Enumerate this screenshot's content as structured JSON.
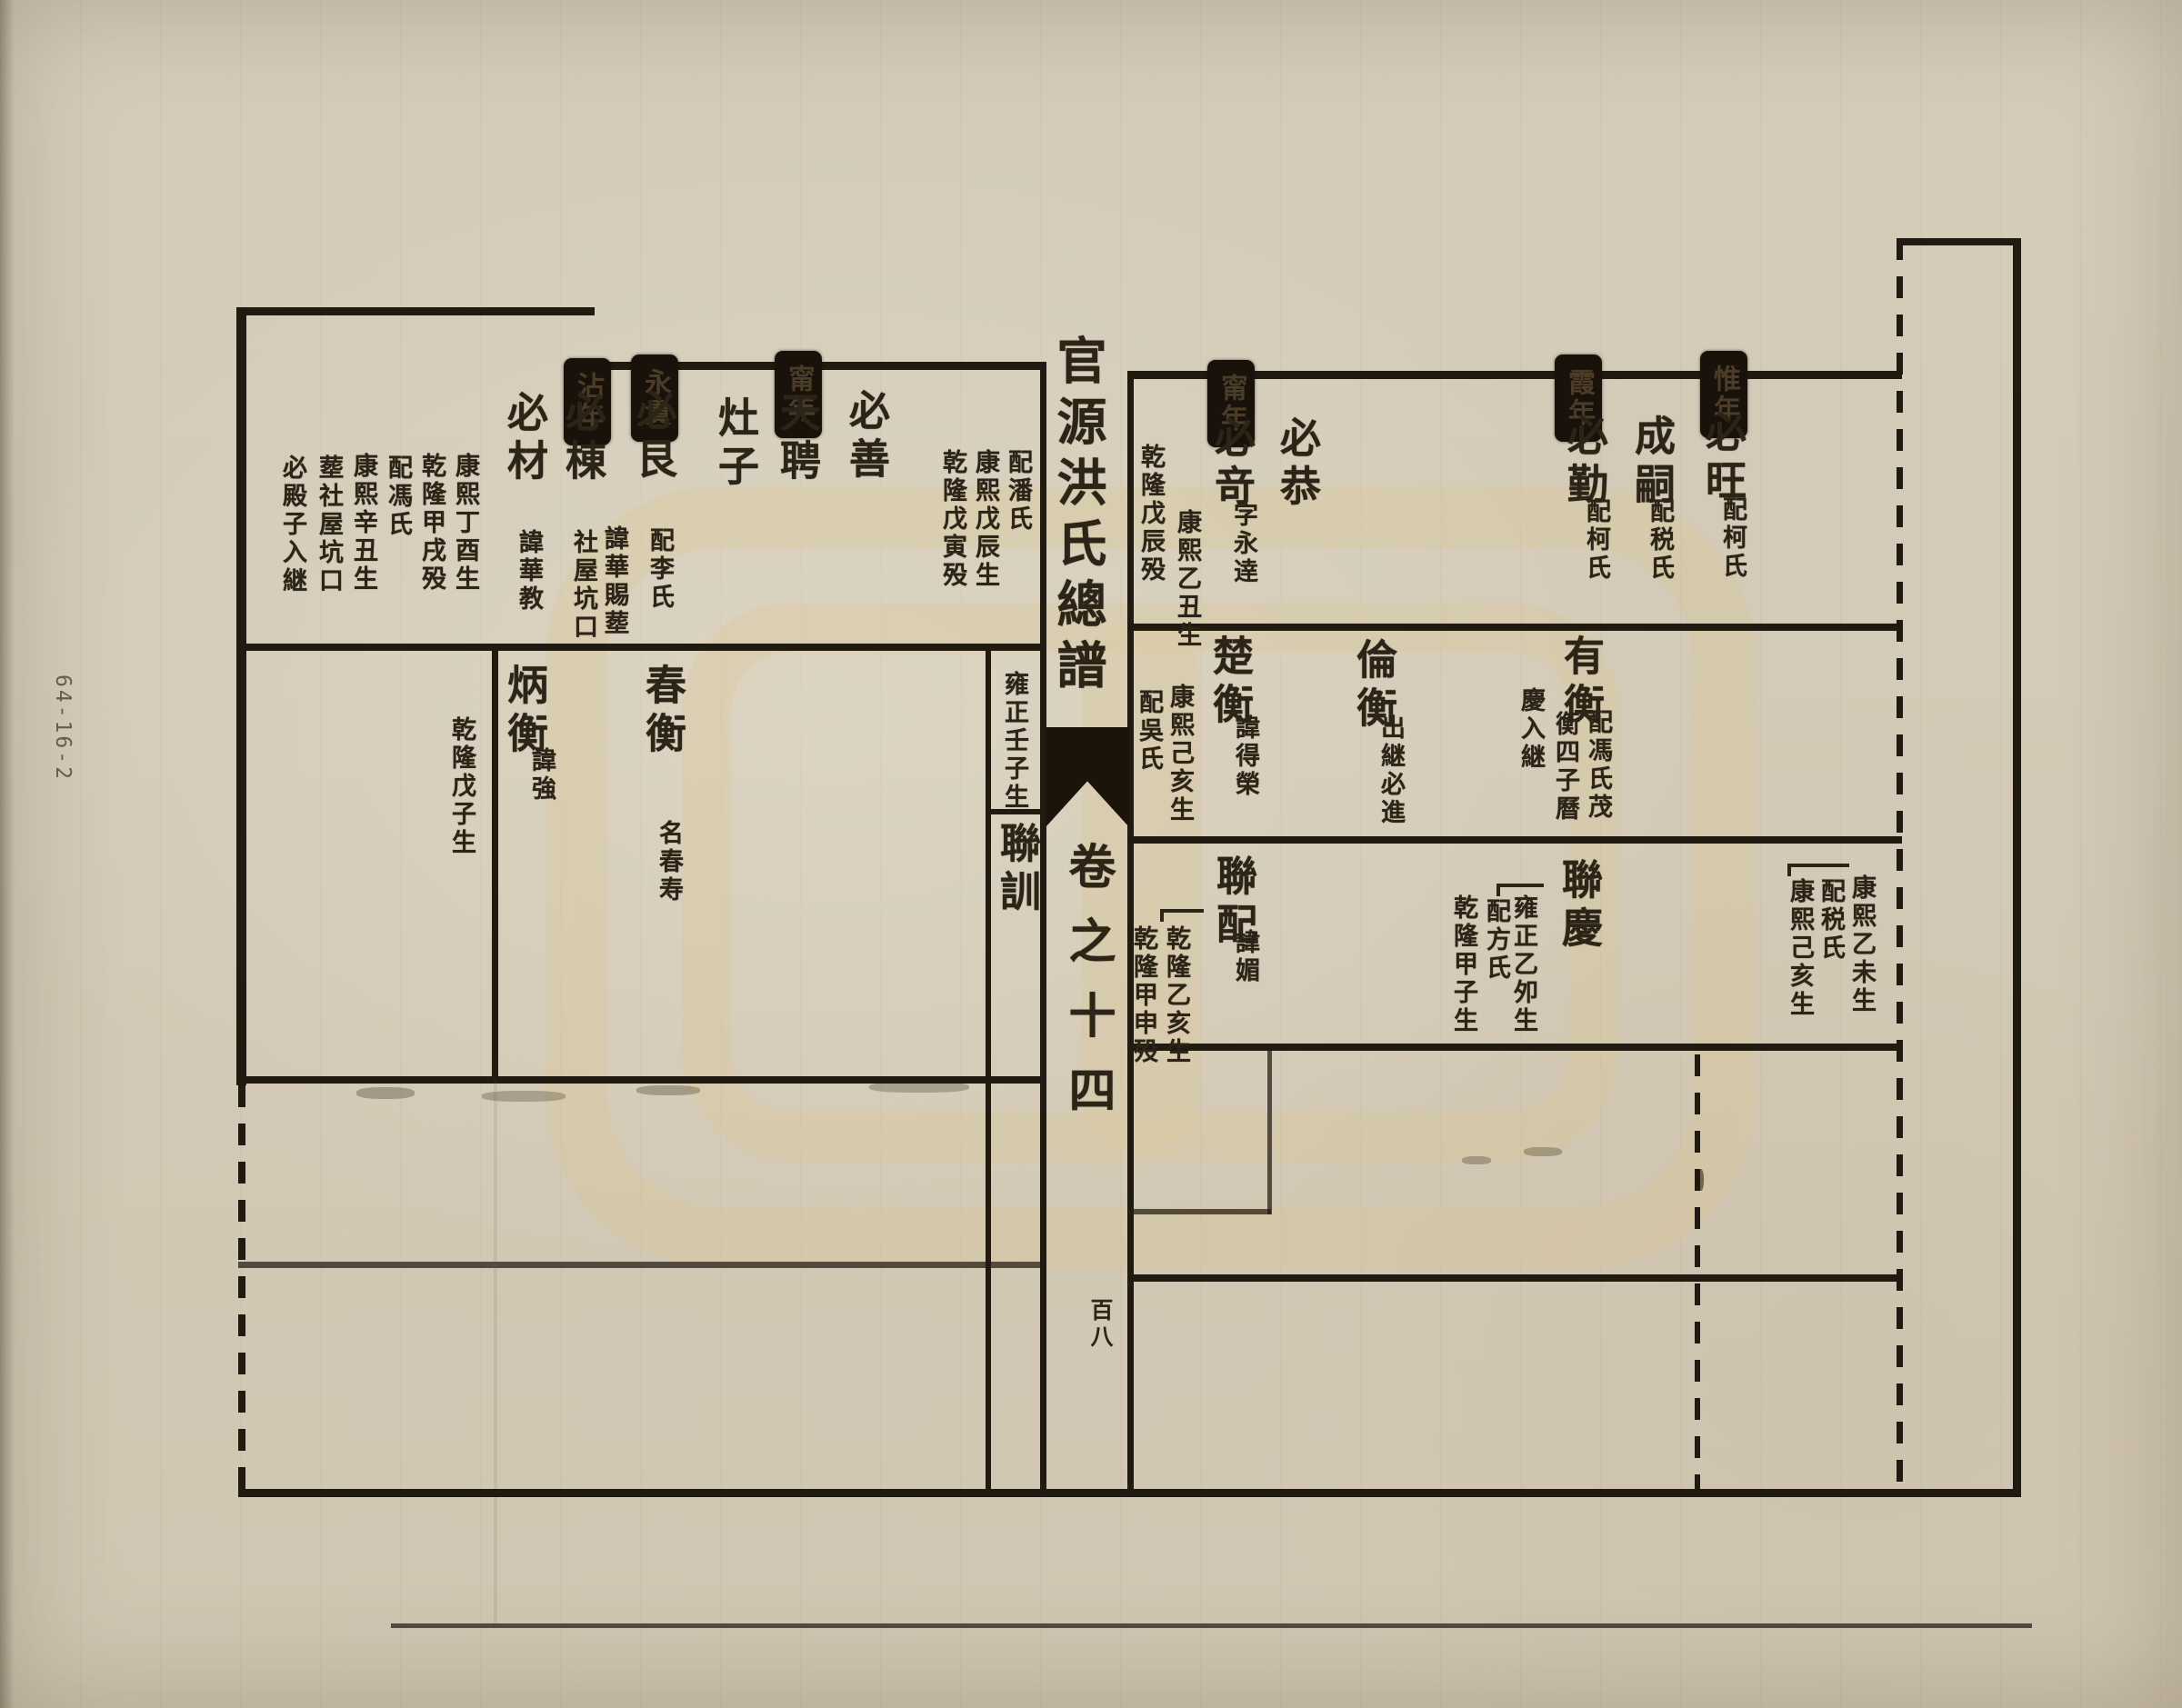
{
  "margin_label": "64-16-2",
  "fold": {
    "title": "官源洪氏總譜",
    "volume": "卷之十四",
    "page_number": "百八"
  },
  "left": {
    "box1": "沾年",
    "box2": "永貴",
    "box3": "甯年",
    "r1": {
      "wife_d1": "配潘氏",
      "wife_d2": "康熙戊辰生",
      "wife_d3": "乾隆戊寅殁",
      "bishan": "必善",
      "tianpin": "天聘",
      "zaozi": "灶子",
      "bigen": "必艮",
      "bigen_d1": "配李氏",
      "bidong": "必棟",
      "bidong_d1": "諱華賜塟",
      "bidong_d2": "社屋坑口",
      "bicai": "必材",
      "bicai_d1": "諱華教",
      "det1": "康熙丁酉生",
      "det2": "乾隆甲戌殁",
      "det3": "配馮氏",
      "det4": "康熙辛丑生",
      "det5": "塟社屋坑口",
      "det6": "必殿子入継"
    },
    "r2": {
      "note": "雍正壬子生",
      "chunheng": "春衡",
      "chunheng_d1": "名春寿",
      "bingheng": "炳衡",
      "bingheng_d1": "諱強",
      "bingheng_d2": "乾隆戊子生"
    },
    "r3": {
      "lianxun": "聯訓"
    }
  },
  "right": {
    "box1": "甯年",
    "box2": "霞年",
    "box3": "惟年",
    "r1": {
      "biqi": "必竒",
      "biqi_d1": "字永逹",
      "biqi_d2": "康熙乙丑生",
      "biqi_d3": "乾隆戊辰殁",
      "bigong": "必恭",
      "biqin": "必勤",
      "biqin_d1": "配柯氏",
      "chengsi": "成嗣",
      "chengsi_d1": "配税氏",
      "biwang": "必旺",
      "biwang_d1": "配柯氏"
    },
    "r2": {
      "chuheng": "楚衡",
      "chuheng_d1": "諱得榮",
      "chuheng_d2": "康熙己亥生",
      "chuheng_d3": "配吳氏",
      "lunheng": "倫衡",
      "lunheng_d1": "出継必進",
      "youheng": "有衡",
      "youheng_d1": "配馮氏茂",
      "youheng_d2": "衡四子曆",
      "youheng_d3": "慶入継"
    },
    "r3": {
      "lianpei": "聯配",
      "lianpei_d1": "諱媚",
      "lianpei_d2": "乾隆乙亥生",
      "lianpei_d3": "乾隆甲申殁",
      "lianqing": "聯慶",
      "lianqing_d1": "雍正乙夘生",
      "lianqing_d2": "配方氏",
      "lianqing_d3": "乾隆甲子生",
      "cont_d1": "康熙乙未生",
      "cont_d2": "配税氏",
      "cont_d3": "康熙己亥生"
    }
  }
}
